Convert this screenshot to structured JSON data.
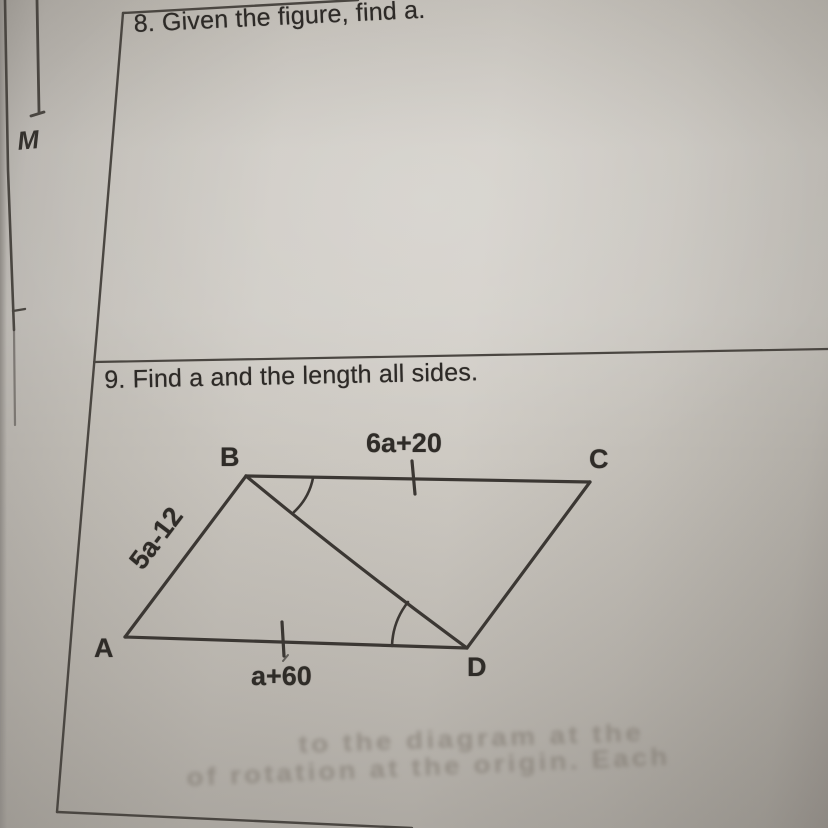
{
  "photo": {
    "margin_letter": "M",
    "questions": {
      "q8": {
        "text": "8. Given the figure, find a."
      },
      "q9": {
        "text": "9. Find a and the length all sides.",
        "figure": {
          "vertex_a": "A",
          "vertex_b": "B",
          "vertex_c": "C",
          "vertex_d": "D",
          "top_side_label": "6a+20",
          "left_side_label": "5a-12",
          "bottom_side_label": "a+60"
        }
      }
    },
    "ghost_text": {
      "line1": "to the diagram at the",
      "line2": "of rotation at the origin. Each"
    },
    "colors": {
      "paper": "#c8c4bd",
      "ink": "#2d2a27",
      "figure_line": "#3b3733",
      "border_line": "#4a4641"
    }
  }
}
